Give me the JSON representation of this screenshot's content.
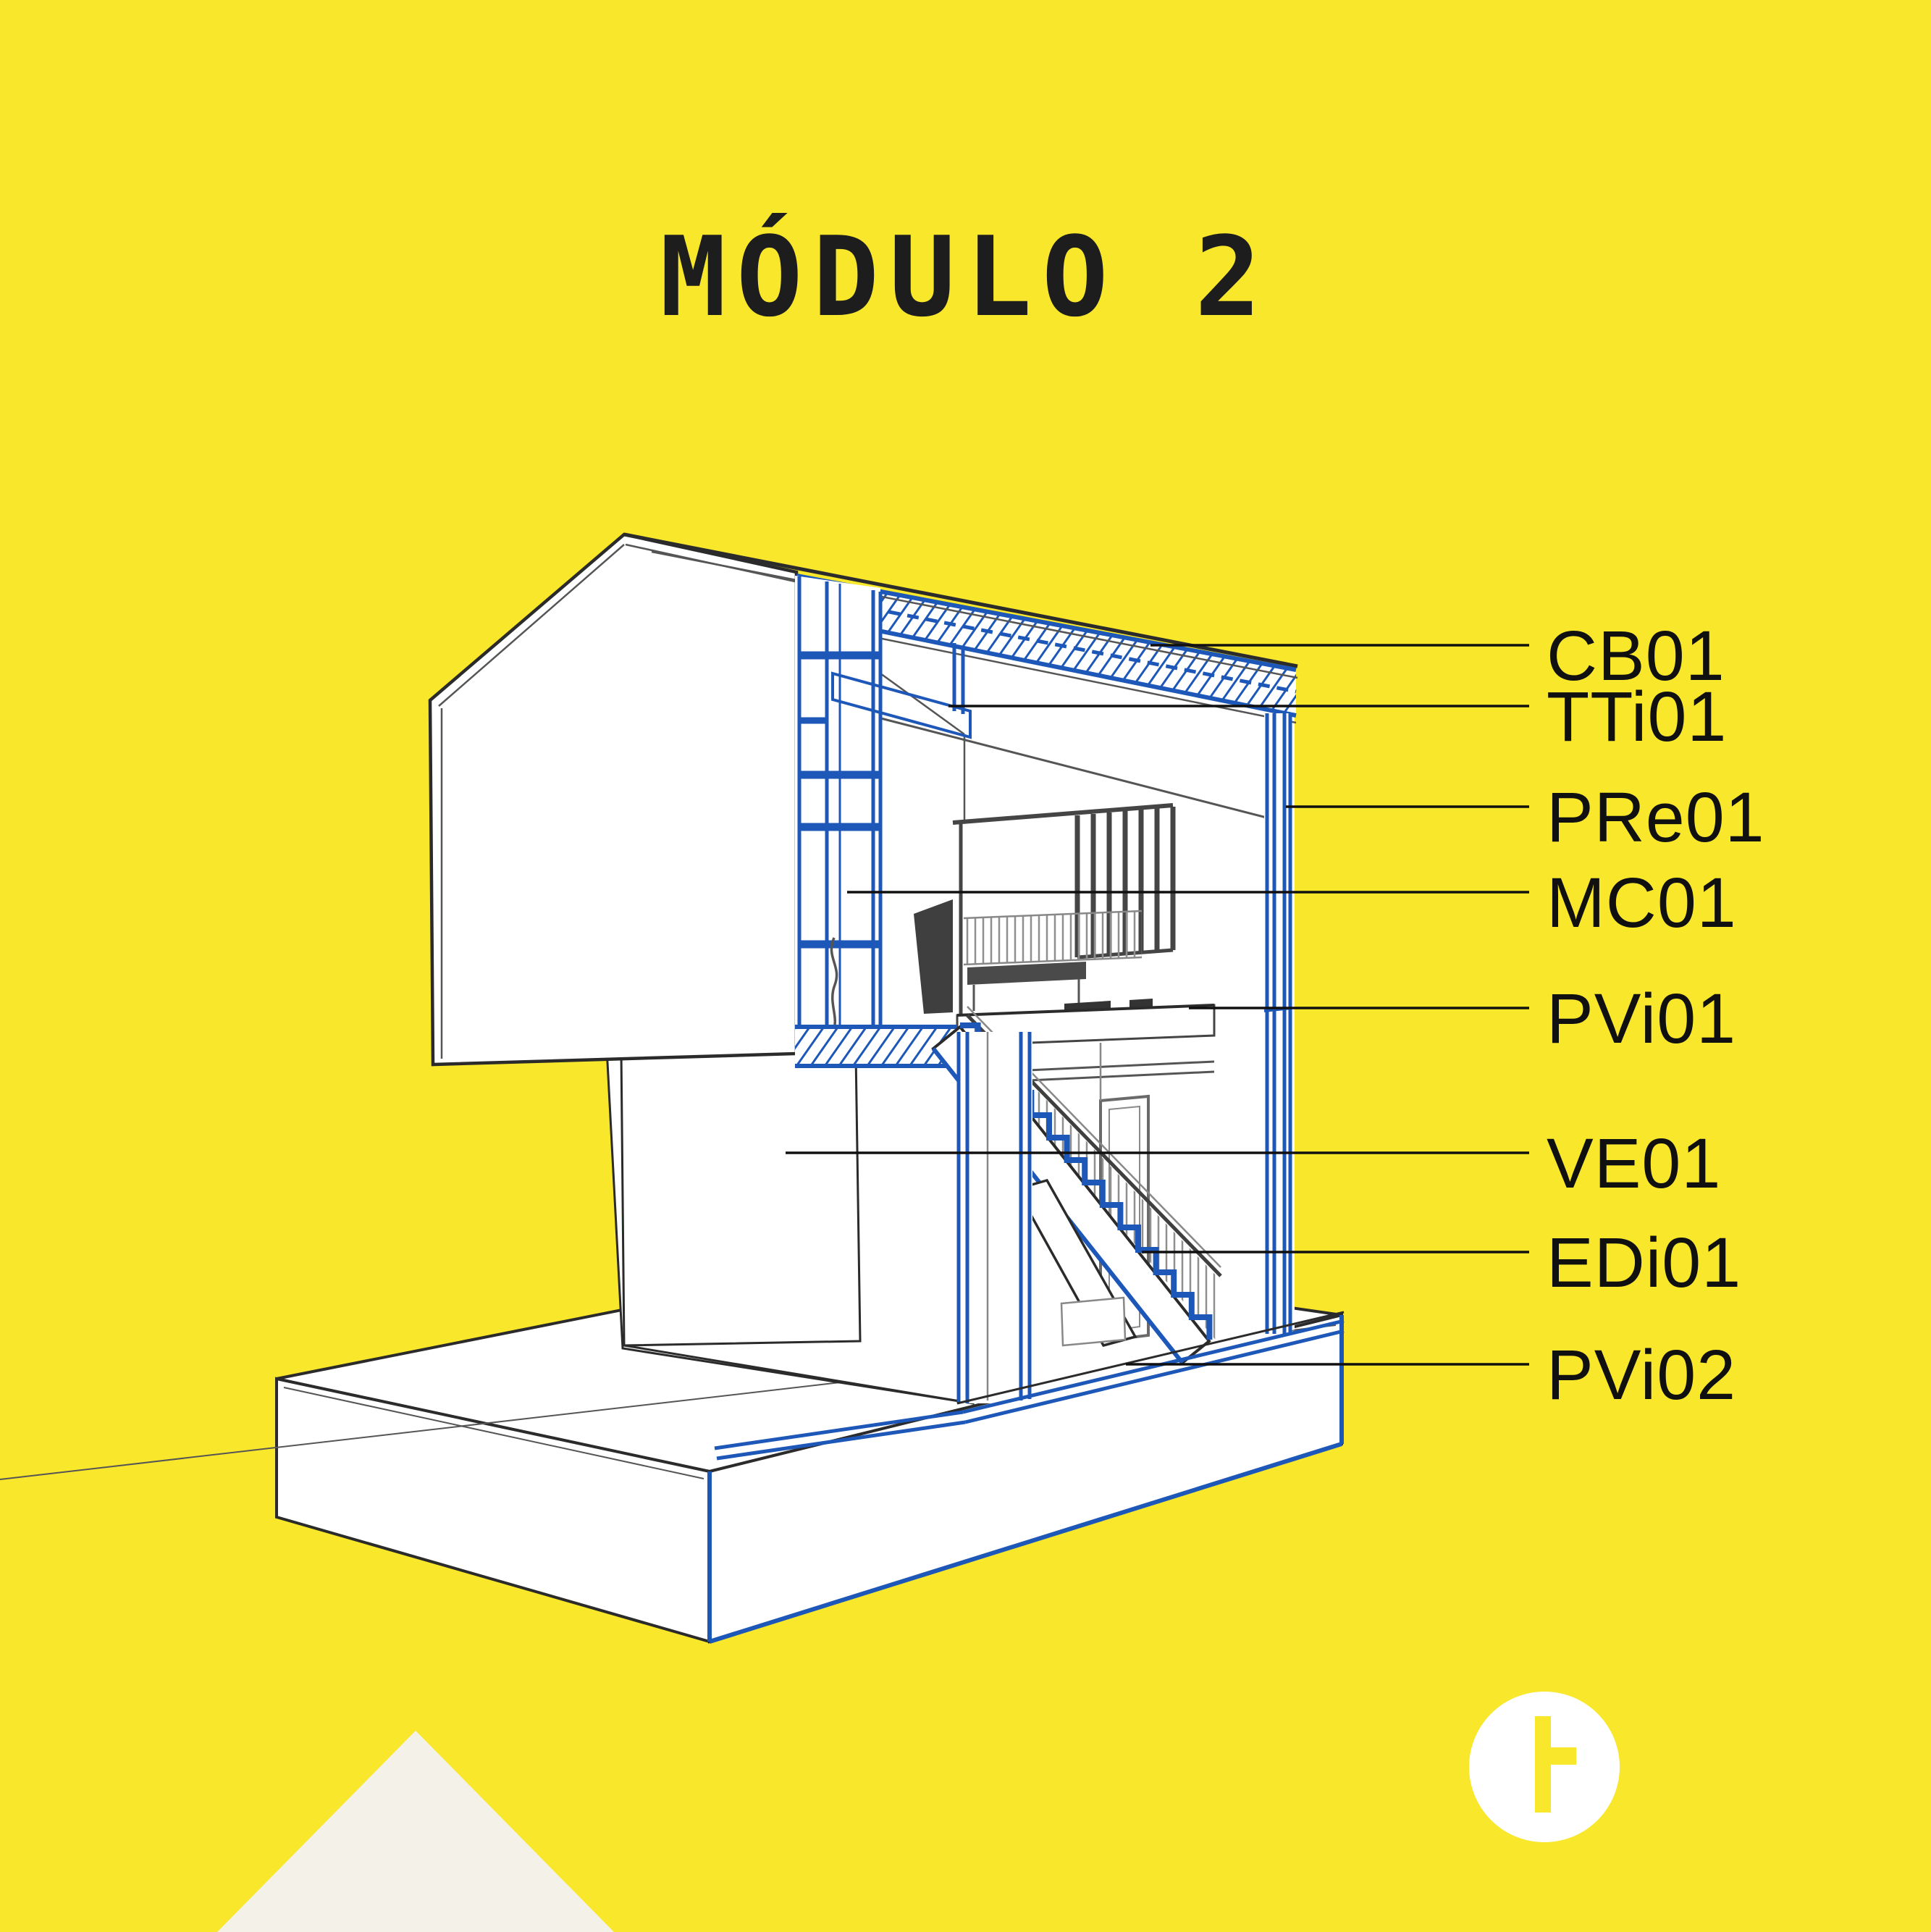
{
  "title": "MÓDULO 2",
  "labels": [
    "CB01",
    "TTi01",
    "PRe01",
    "MC01",
    "PVi01",
    "VE01",
    "EDi01",
    "PVi02"
  ],
  "colors": {
    "background": "#F8E72B",
    "accent_blue": "#1D57B8",
    "ink": "#1d1d1d",
    "triangle_cream": "#F4F2E8",
    "logo_white": "#FFFFFF"
  },
  "logo": {
    "icon": "circle-t-mark"
  }
}
